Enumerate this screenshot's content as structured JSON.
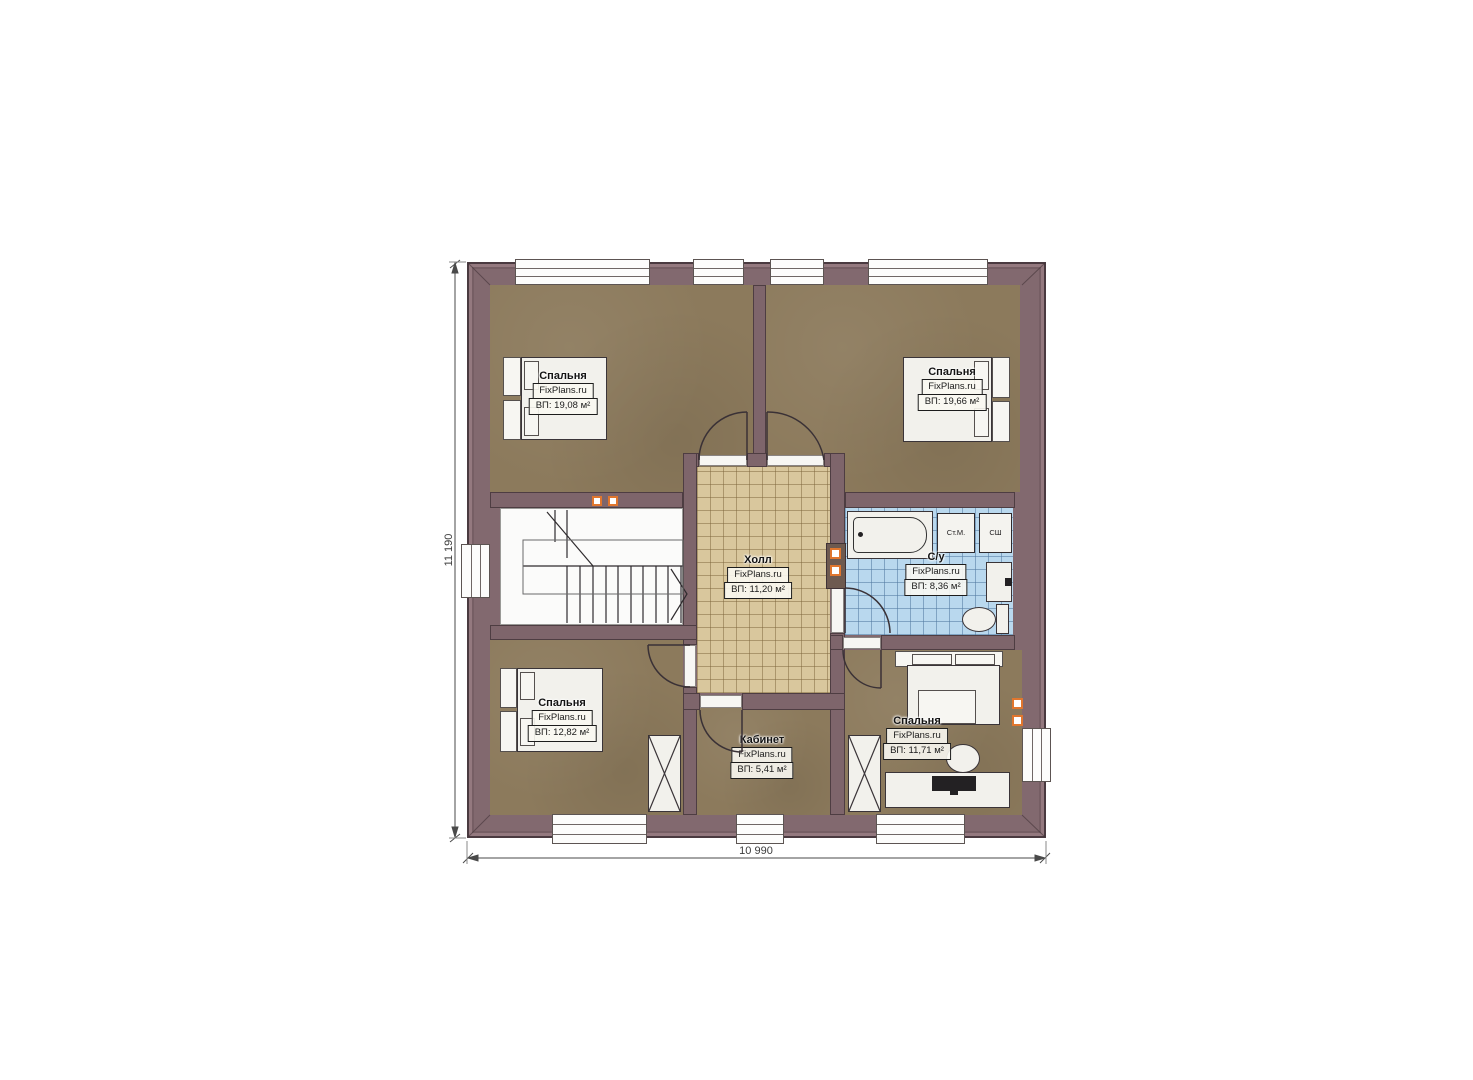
{
  "brand": "FixPlans.ru",
  "dimensions": {
    "horizontal": "10 990",
    "vertical": "11 190"
  },
  "rooms": {
    "bedroom_top_left": {
      "name": "Спальня",
      "area": "ВП: 19,08 м²"
    },
    "bedroom_top_right": {
      "name": "Спальня",
      "area": "ВП: 19,66 м²"
    },
    "hall": {
      "name": "Холл",
      "area": "ВП: 11,20 м²"
    },
    "bathroom": {
      "name": "С/у",
      "area": "ВП: 8,36 м²"
    },
    "bedroom_bottom_left": {
      "name": "Спальня",
      "area": "ВП: 12,82 м²"
    },
    "office": {
      "name": "Кабинет",
      "area": "ВП: 5,41 м²"
    },
    "bedroom_bottom_right": {
      "name": "Спальня",
      "area": "ВП: 11,71 м²"
    }
  },
  "appliances": {
    "washing_machine": "Ст.М.",
    "drying_cabinet": "СШ"
  },
  "colors": {
    "wall": "#7e656b",
    "floor_wood": "#8c7a5c",
    "floor_tile": "#d9c79d",
    "floor_bath": "#b9d8ee",
    "accent_orange": "#e0762e"
  }
}
